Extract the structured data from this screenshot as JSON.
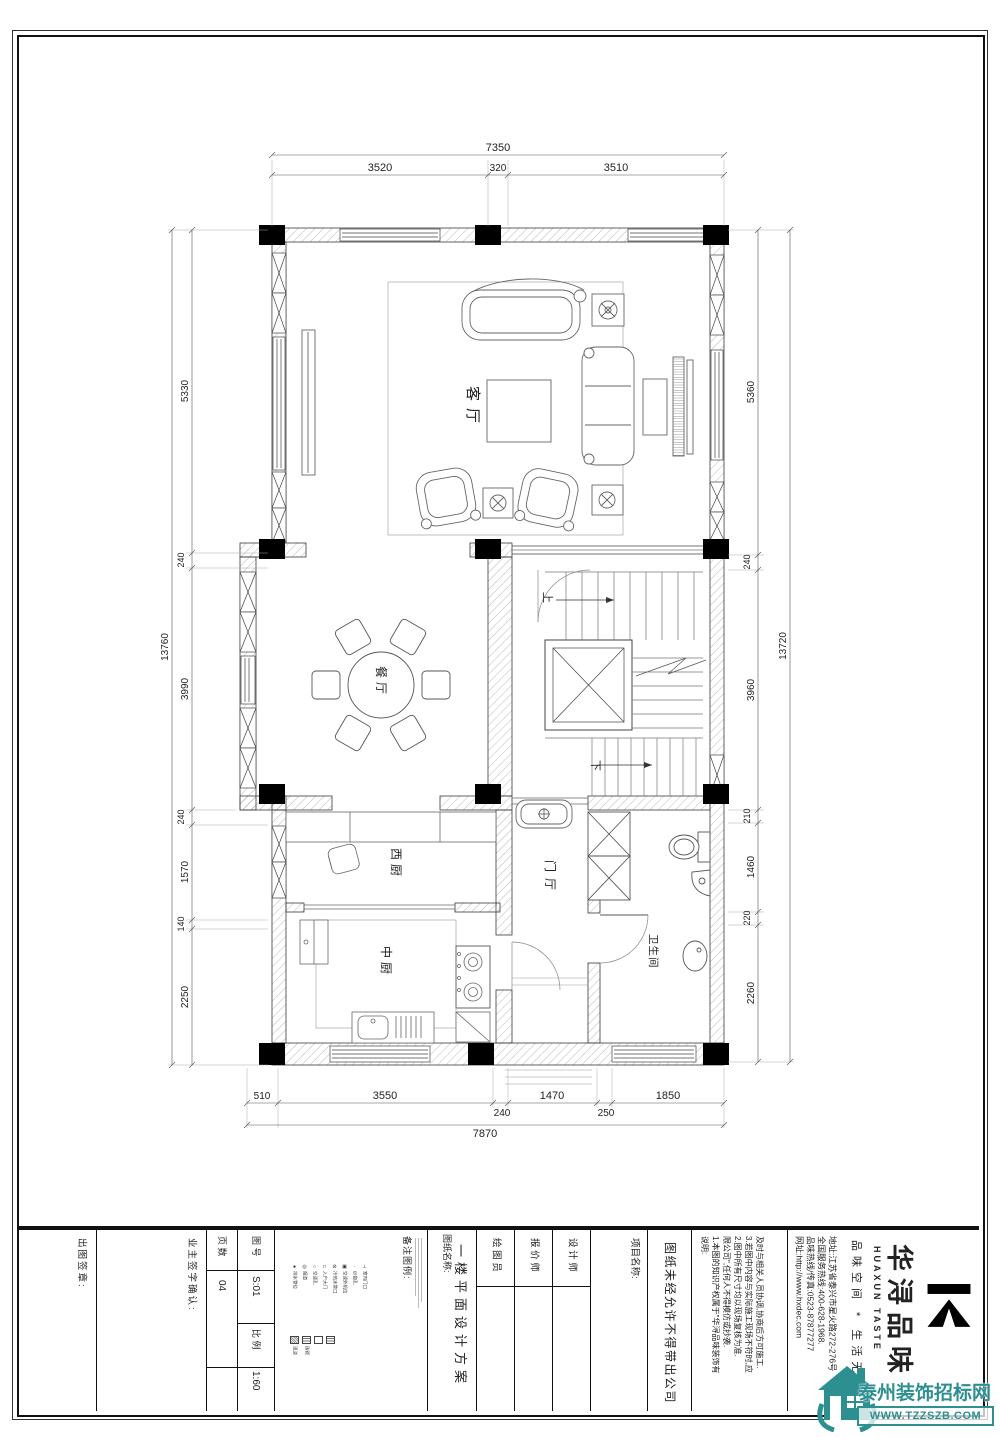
{
  "dims": {
    "top": {
      "total": "7350",
      "segments": [
        "3520",
        "320",
        "3510"
      ]
    },
    "bottom": {
      "total": "7870",
      "segments": [
        "510",
        "3550",
        "240",
        "1470",
        "250",
        "1850"
      ]
    },
    "left": {
      "total": "13760",
      "segments": [
        "5330",
        "240",
        "3990",
        "240",
        "1570",
        "140",
        "2250"
      ]
    },
    "right": {
      "total": "13720",
      "segments": [
        "5360",
        "240",
        "3960",
        "210",
        "1460",
        "220",
        "2260"
      ]
    }
  },
  "rooms": {
    "living": "客厅",
    "dining": "餐厅",
    "west_kitchen": "西厨",
    "chinese_kitchen": "中厨",
    "foyer": "门厅",
    "bathroom": "卫生间",
    "stair_up": "上",
    "stair_down": "下"
  },
  "titleblock": {
    "stamp": "出图签章:",
    "owner_sign": "业主签字确认:",
    "pages_label": "页 数",
    "pages_value": "04",
    "figno_label": "图 号",
    "figno_value": "S:01",
    "scale_label": "比 例",
    "scale_value": "1:60",
    "legend_label": "备注图例:",
    "legend_row1": [
      {
        "sym": "●",
        "label": "排水管位"
      },
      {
        "sym": "◎",
        "label": "烟道"
      },
      {
        "sym": "○",
        "label": "空调孔"
      },
      {
        "sym": "□",
        "label": "入户大门"
      },
      {
        "sym": "⊘",
        "label": "冷热水管口"
      },
      {
        "sym": "▣",
        "label": "空调外机位"
      },
      {
        "sym": "·",
        "label": "纱窗孔"
      },
      {
        "sym": "⊥",
        "label": "室内门口"
      }
    ],
    "legend_row2": [
      {
        "label": "现浇"
      },
      {
        "label": "砖砌"
      }
    ],
    "sheet_label": "图纸名称:",
    "sheet_name": "一楼平面设计方案",
    "drafter": "绘 图 员",
    "quoter": "报 价 师",
    "designer": "设 计 师",
    "project_label": "项目名称:",
    "warning": "图纸未经允许不得带出公司",
    "notes": [
      "说明:",
      "1.本图的知识产权属于\"华浔品味装饰有",
      "限公司\",任何人不得模仿或抄袭.",
      "2.图中所有尺寸均以现场复核为准.",
      "3.若图中内容与实际施工现场不符时,应",
      "及时与相关人员协调,协商后方可施工."
    ],
    "company": {
      "web": "网址:http://www.hxdec.com",
      "fax": "品味热线/传真:0523-87877277",
      "hotline": "全国服务热线:400-628-1968.",
      "addr": "地址:江苏省泰兴市星火路272-276号",
      "slogan": "品味空间 * 生活无限",
      "brand_en": "HUAXUN TASTE",
      "brand": "华浔品味"
    }
  },
  "watermark": {
    "name": "泰州装饰招标网",
    "url": "WWW.TZZSZB.COM",
    "color": "#2e8f91"
  }
}
